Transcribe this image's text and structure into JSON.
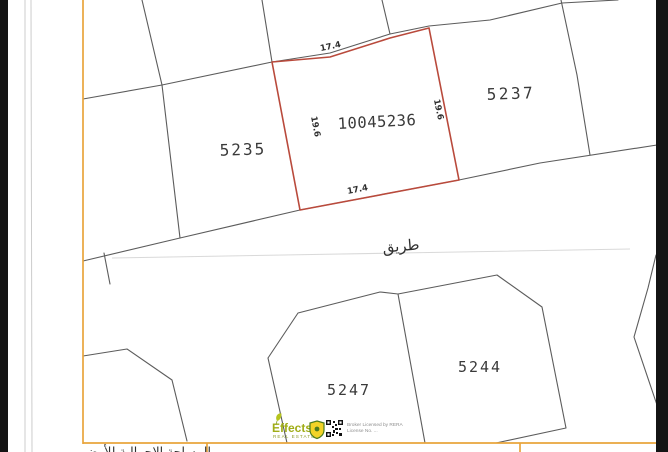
{
  "colors": {
    "map_border": "#e8a43c",
    "highlight": "#b94a3c",
    "map_line": "#5c5c5c",
    "label": "#3a3a3a",
    "logo_green": "#a0ad17",
    "logo_shield_yellow": "#f2d327",
    "scan_edge": "#141414"
  },
  "plots": {
    "left_label": "5235",
    "highlighted_label": "10045236",
    "right_label": "5237",
    "bottom_left_label": "5247",
    "bottom_right_label": "5244"
  },
  "dimensions": {
    "top": "17.4",
    "bottom": "17.4",
    "left": "19.6",
    "right": "19.6"
  },
  "road_label": "طريق",
  "footer": {
    "brand": "Effects",
    "brand_sub": "REAL ESTATE",
    "license_line1": "Broker Licensed by RERA",
    "license_line2": "License No. ...",
    "bottom_table_label": "المساحة الإجمالية للأرض"
  }
}
